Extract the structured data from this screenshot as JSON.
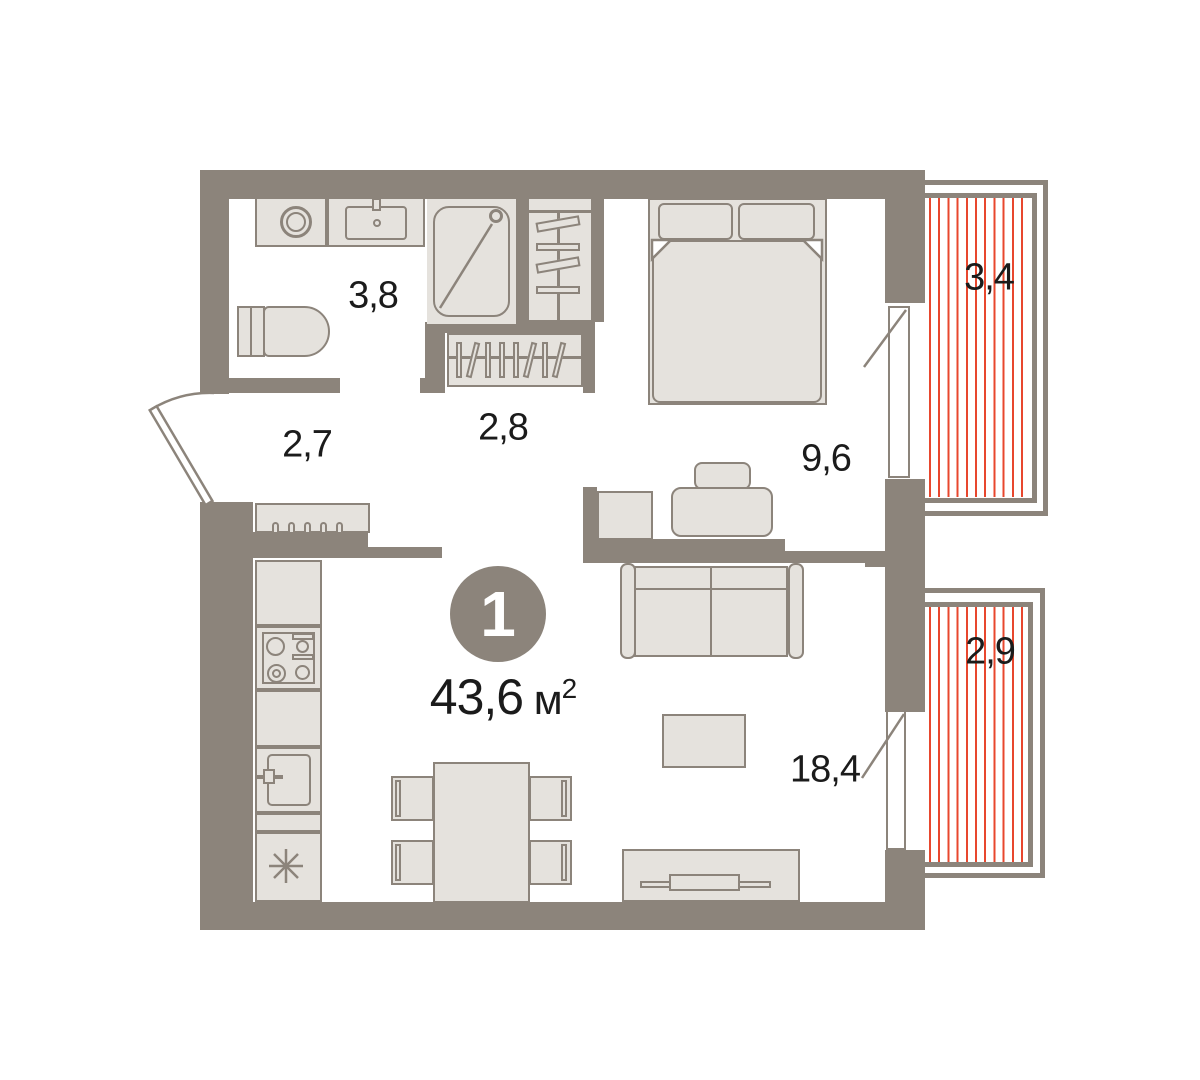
{
  "plan": {
    "badge": {
      "number": "1"
    },
    "area": {
      "value": "43,6",
      "unit": "м",
      "exponent": "2"
    },
    "rooms": [
      {
        "name": "bathroom",
        "area": "3,8"
      },
      {
        "name": "hallway",
        "area": "2,7"
      },
      {
        "name": "closet",
        "area": "2,8"
      },
      {
        "name": "bedroom",
        "area": "9,6"
      },
      {
        "name": "living-kitchen",
        "area": "18,4"
      },
      {
        "name": "balcony-upper",
        "area": "3,4"
      },
      {
        "name": "balcony-lower",
        "area": "2,9"
      }
    ],
    "colors": {
      "wall": "#8C847B",
      "furniture_fill": "#E5E2DD",
      "outline": "#8C847B",
      "balcony_hatch": "#E8472E",
      "label_text": "#1B1B1B",
      "badge_text": "#FFFFFF",
      "background": "#FFFFFF"
    }
  }
}
